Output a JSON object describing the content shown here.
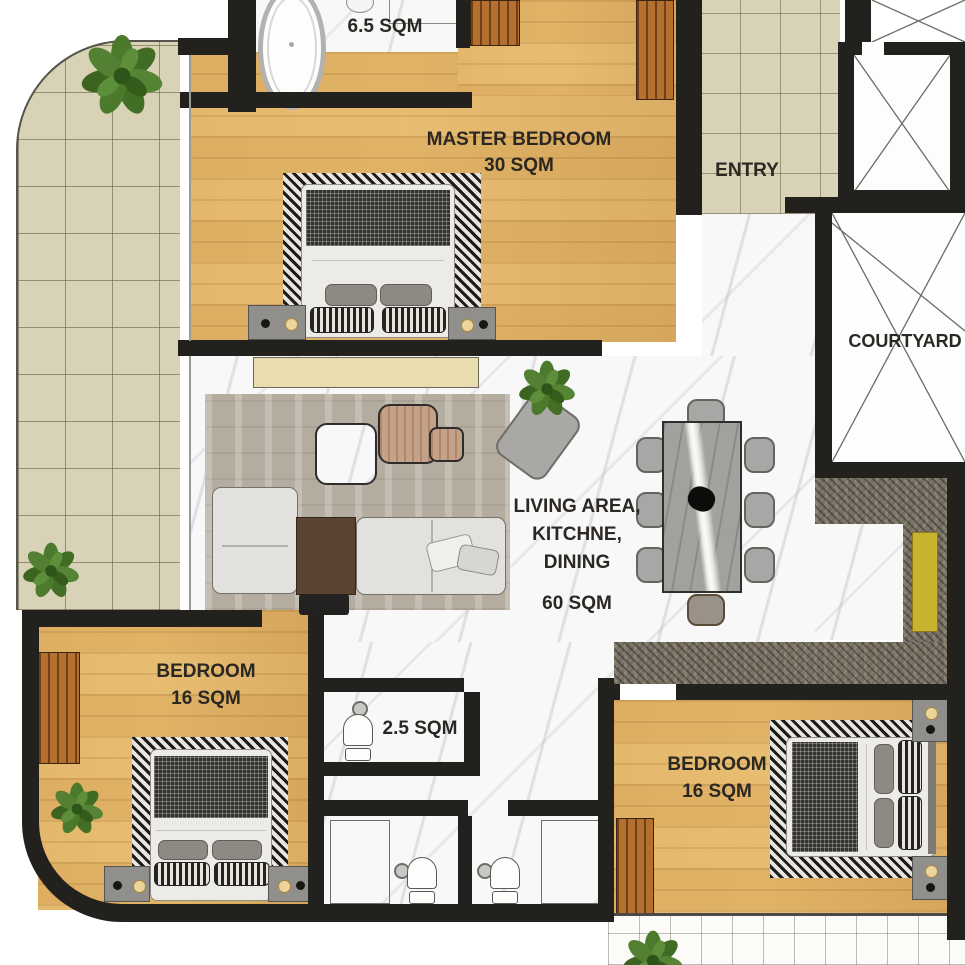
{
  "theme": {
    "wall": "#23211e",
    "wood": "#e7bd72",
    "tile-beige": "#d8d2b6",
    "marble": "#f8f8f9",
    "granite": "#756f62",
    "rug-living": "#b4ac9f",
    "accent-yellow": "#c8b22e",
    "plant-green": "#4c7a2c",
    "label-color": "#2b2722"
  },
  "rooms": {
    "master_bathroom": {
      "area_label": "6.5 SQM",
      "floor": "marble"
    },
    "master_bedroom": {
      "name": "MASTER BEDROOM",
      "area_label": "30 SQM",
      "floor": "wood"
    },
    "entry": {
      "name": "ENTRY",
      "floor": "tile"
    },
    "courtyard": {
      "name": "COURTYARD"
    },
    "living_kitchen_dining": {
      "name_line1": "LIVING AREA,",
      "name_line2": "KITCHNE,",
      "name_line3": "DINING",
      "area_label": "60 SQM",
      "floor": "marble"
    },
    "bedroom_left": {
      "name": "BEDROOM",
      "area_label": "16 SQM",
      "floor": "wood"
    },
    "bathroom_small": {
      "area_label": "2.5 SQM",
      "floor": "marble"
    },
    "bedroom_right": {
      "name": "BEDROOM",
      "area_label": "16 SQM",
      "floor": "wood"
    }
  }
}
